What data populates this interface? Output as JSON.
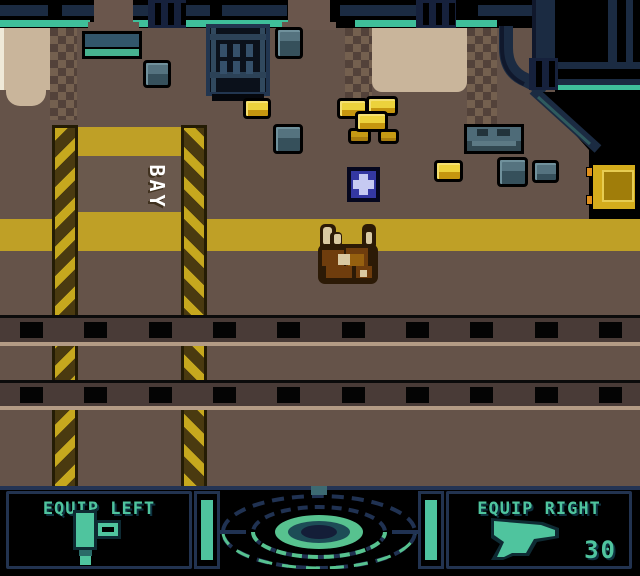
{
  "meta": {
    "width": 640,
    "height": 576,
    "style": "gameboy-color-4x-pixels"
  },
  "signs": {
    "bay": "BAY"
  },
  "hud": {
    "left_panel": {
      "label": "EQUIP LEFT",
      "icon": "tool-icon"
    },
    "right_panel": {
      "label": "EQUIP RIGHT",
      "icon": "pistol-icon",
      "ammo": "30"
    },
    "left_bar": {
      "color": "#4fc49e",
      "state": "full"
    },
    "right_bar": {
      "color": "#4fc49e",
      "state": "full"
    },
    "radar": {
      "icon": "motion-tracker-radar"
    }
  },
  "palette": {
    "floor": "#655349",
    "wall_black": "#000000",
    "pipe_navy": "#1b2b42",
    "pipe_light": "#2c4257",
    "accent_teal": "#3fbf9a",
    "panel_slate": "#32566b",
    "panel_teal": "#47b390",
    "beige": "#c9b59b",
    "beige_light": "#efe9d8",
    "dither_a": "#74604f",
    "dither_b": "#53423a",
    "hazard_yellow": "#c6a81e",
    "hazard_dark": "#4a3a10",
    "stripe_yellow": "#bfa026",
    "crate_yellow": "#e6c42e",
    "crate_yellow_dark": "#c5960f",
    "crate_gray": "#55737f",
    "crate_gray_dark": "#36505b",
    "cart_yellow": "#d4ac1c",
    "cart_inner": "#a07d0a",
    "cart_knob": "#e0901c",
    "track_band": "#493b37",
    "track_tan": "#b39b85",
    "medkit_blue": "#3438a2",
    "medkit_cross": "#c6caf2",
    "creature_dark": "#2c1a06",
    "creature_mid": "#6f3d0d",
    "creature_light": "#96600f",
    "creature_cream": "#d9c9a2",
    "hud_teal": "#4fc49e",
    "hud_border": "#223350",
    "radar_navy": "#203252",
    "radar_green": "#57c28f"
  },
  "scene": {
    "pillars": [
      {
        "x": 52,
        "dir": "l"
      },
      {
        "x": 181,
        "dir": "r"
      }
    ],
    "crates": [
      {
        "type": "gray",
        "x": 143,
        "y": 60,
        "w": 28,
        "h": 28
      },
      {
        "type": "gray",
        "x": 275,
        "y": 27,
        "w": 28,
        "h": 32
      },
      {
        "type": "gray",
        "x": 273,
        "y": 124,
        "w": 30,
        "h": 30
      },
      {
        "type": "yellow",
        "x": 243,
        "y": 98,
        "w": 28,
        "h": 21
      },
      {
        "type": "yellow",
        "x": 337,
        "y": 98,
        "w": 31,
        "h": 21
      },
      {
        "type": "yellow",
        "x": 366,
        "y": 96,
        "w": 32,
        "h": 20
      },
      {
        "type": "yellow-dark",
        "x": 348,
        "y": 128,
        "w": 23,
        "h": 16
      },
      {
        "type": "yellow",
        "x": 355,
        "y": 111,
        "w": 33,
        "h": 21
      },
      {
        "type": "yellow-dark",
        "x": 378,
        "y": 129,
        "w": 21,
        "h": 15
      },
      {
        "type": "yellow",
        "x": 434,
        "y": 160,
        "w": 29,
        "h": 22
      },
      {
        "type": "gray",
        "x": 497,
        "y": 157,
        "w": 31,
        "h": 30
      },
      {
        "type": "gray",
        "x": 532,
        "y": 160,
        "w": 27,
        "h": 23
      }
    ],
    "machine": {
      "x": 464,
      "y": 124,
      "w": 60,
      "h": 30
    },
    "cart": {
      "x": 590,
      "y": 162,
      "w": 48,
      "h": 50
    },
    "medkit": {
      "x": 347,
      "y": 167,
      "w": 33,
      "h": 35
    },
    "player": {
      "x": 310,
      "y": 218,
      "w": 80,
      "h": 74
    },
    "tracks": {
      "rows": [
        {
          "top": 315,
          "band_h": 24
        },
        {
          "top": 380,
          "band_h": 23
        }
      ],
      "sleeper_xs": [
        20,
        84,
        149,
        213,
        277,
        342,
        406,
        470,
        535,
        599
      ]
    }
  }
}
